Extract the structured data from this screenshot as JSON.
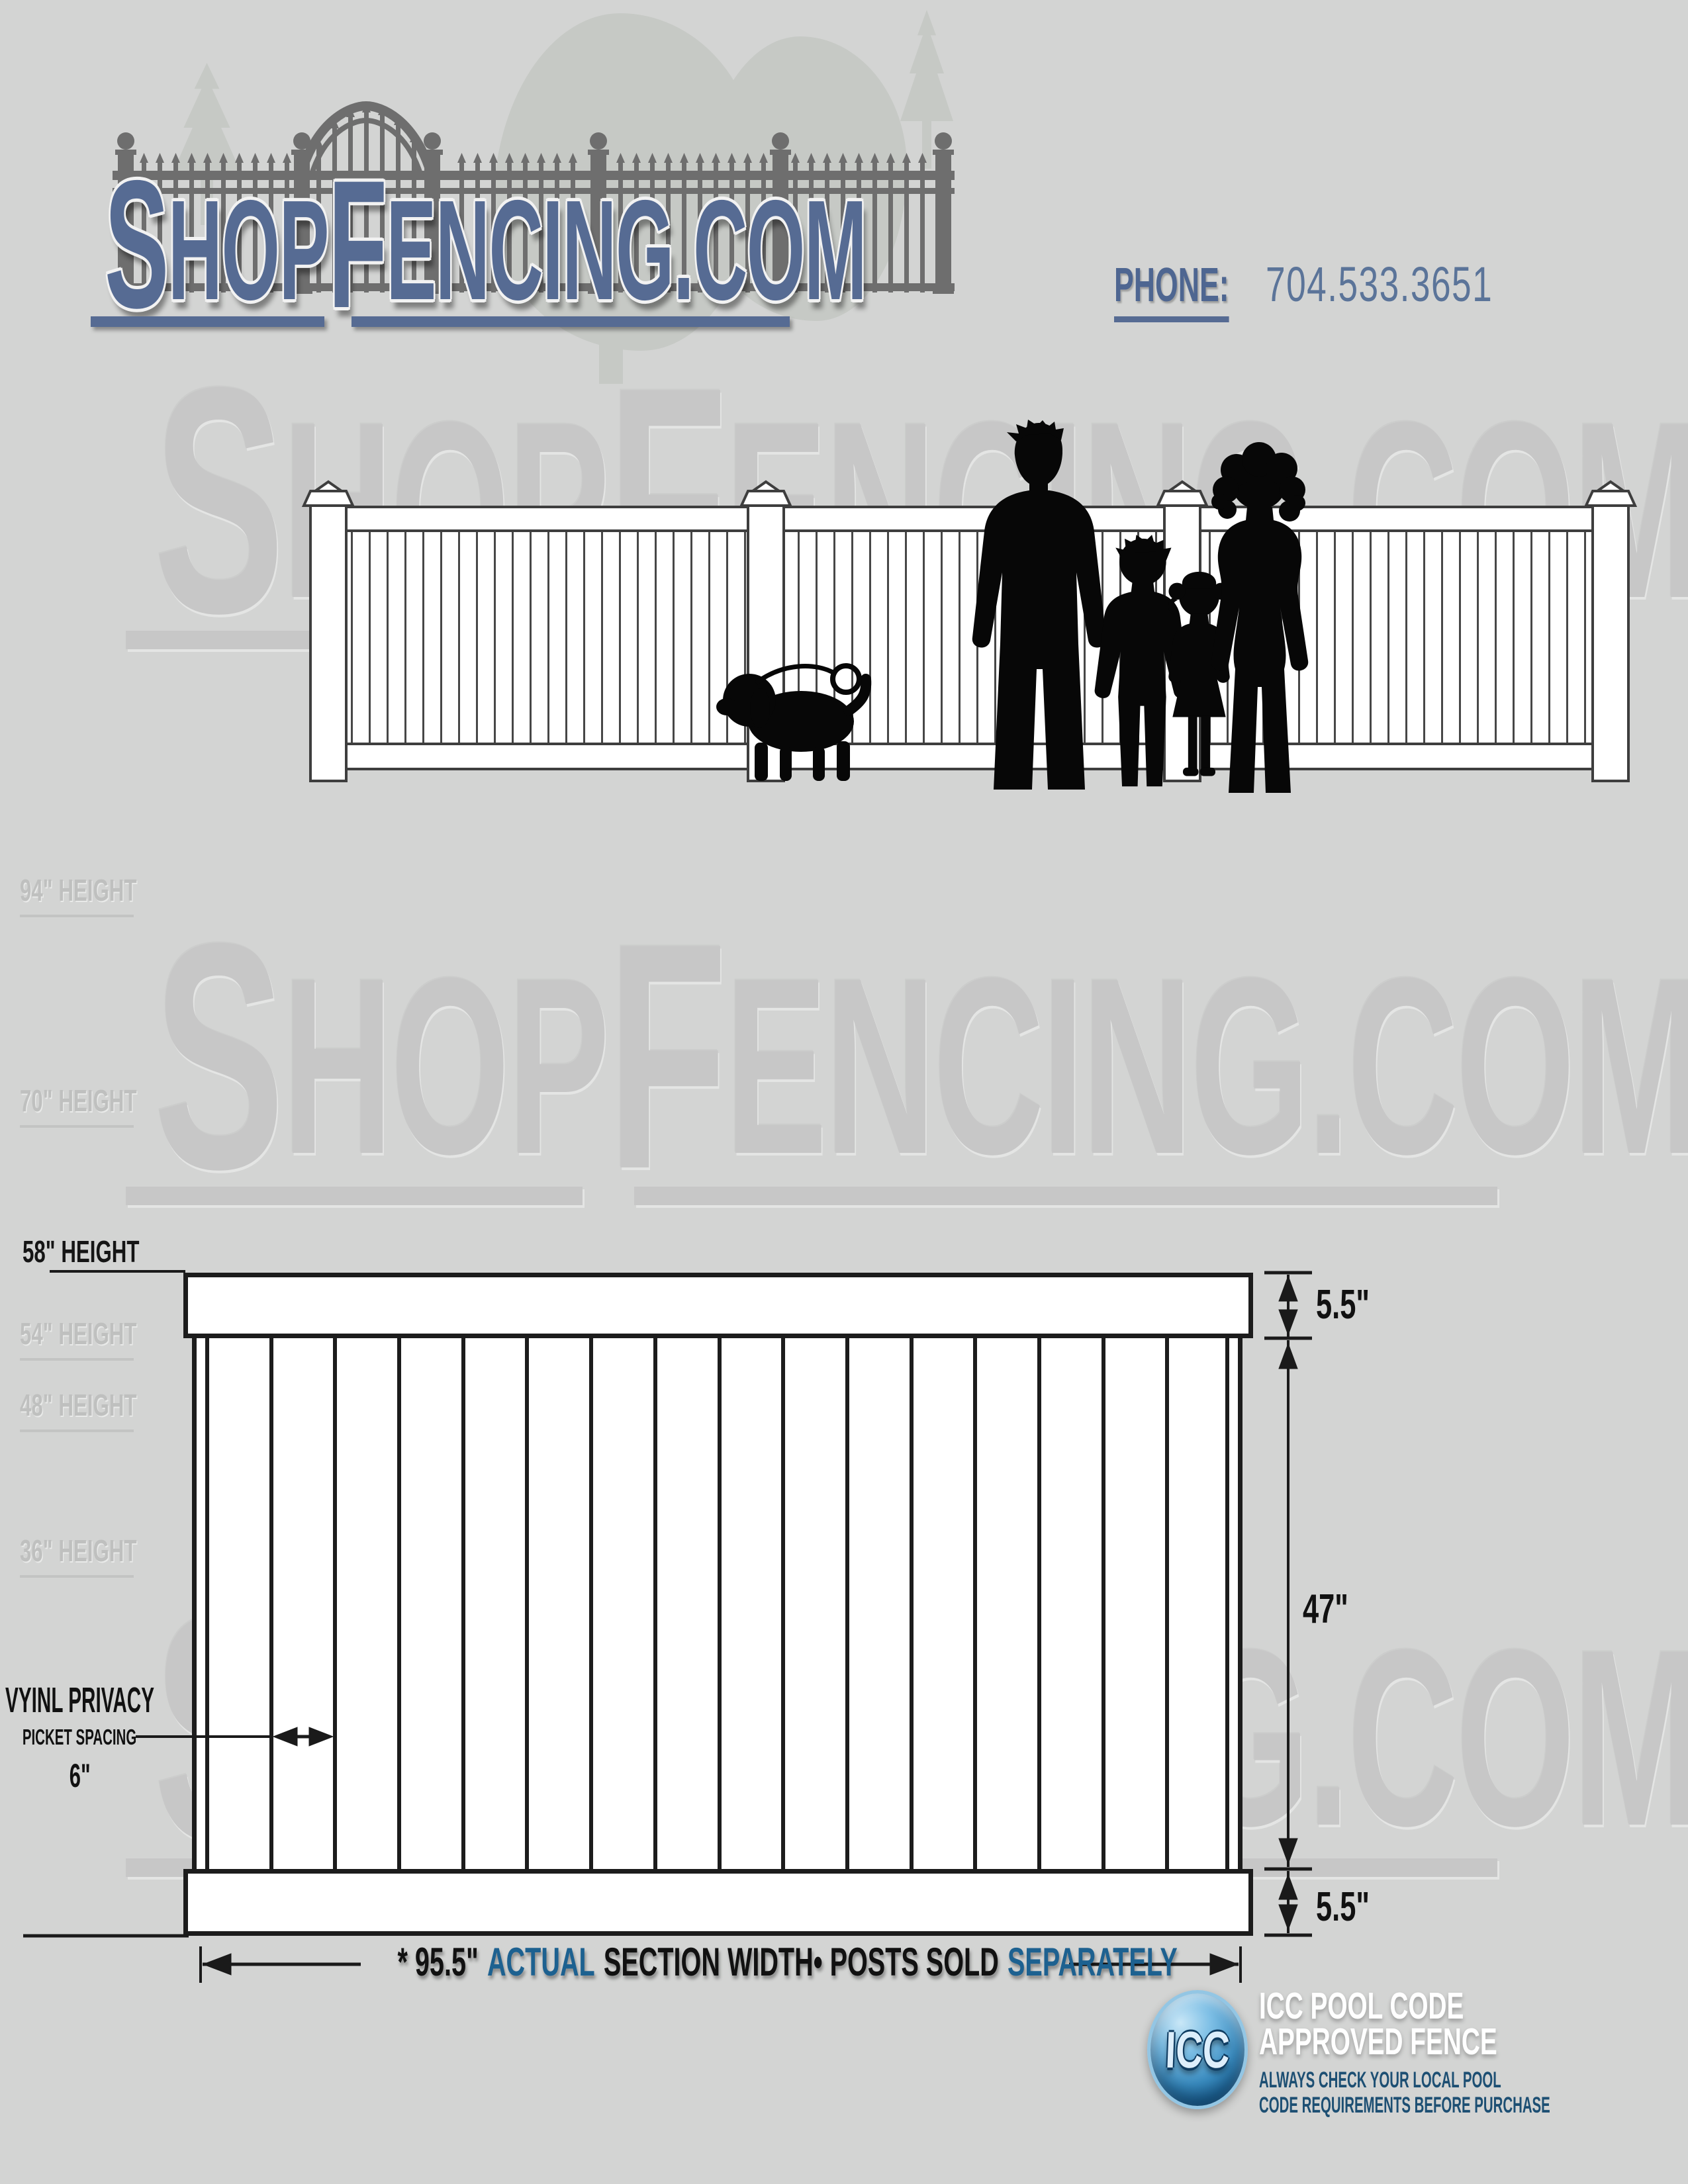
{
  "header": {
    "logo": {
      "s": "S",
      "hop": "HOP",
      "f": "F",
      "rest": "ENCING.COM"
    },
    "phone_label": "PHONE:",
    "phone_number": "704.533.3651"
  },
  "watermark": {
    "s": "S",
    "hop": "HOP",
    "f": "F",
    "rest": "ENCING.COM"
  },
  "heights": [
    {
      "label": "94\" HEIGHT"
    },
    {
      "label": "70\" HEIGHT"
    },
    {
      "label": "58\" HEIGHT"
    },
    {
      "label": "54\" HEIGHT"
    },
    {
      "label": "48\" HEIGHT"
    },
    {
      "label": "36\" HEIGHT"
    }
  ],
  "diagram": {
    "picket_count": 16,
    "top_rail_height": "5.5\"",
    "picket_height": "47\"",
    "bottom_rail_height": "5.5\"",
    "spacing_title": "VYINL PRIVACY",
    "spacing_subtitle": "PICKET SPACING",
    "spacing_value": "6\"",
    "width_note": {
      "measure": "* 95.5\"",
      "word_actual": "ACTUAL",
      "middle": "SECTION WIDTH• POSTS SOLD",
      "word_separately": "SEPARATELY"
    }
  },
  "icc": {
    "badge": "ICC",
    "title_line1": "ICC POOL CODE",
    "title_line2": "APPROVED FENCE",
    "note_line1": "ALWAYS CHECK YOUR LOCAL POOL",
    "note_line2": "CODE REQUIREMENTS BEFORE PURCHASE"
  },
  "colors": {
    "logo_blue": "#566b93",
    "accent_blue": "#1d6190",
    "note_blue": "#1d4f73",
    "background": "#d3d4d3"
  }
}
